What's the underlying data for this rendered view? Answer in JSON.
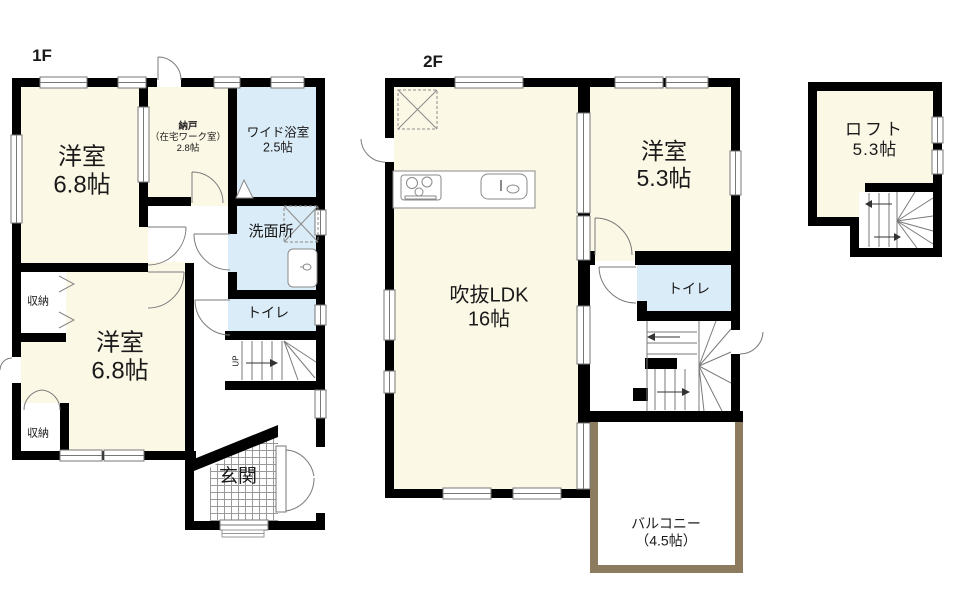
{
  "floors": {
    "f1": "1F",
    "f2": "2F"
  },
  "rooms": {
    "f1_yoshitsu1": {
      "name": "洋室",
      "size": "6.8帖"
    },
    "f1_nando": {
      "name": "納戸",
      "sub": "（在宅ワーク室）",
      "size": "2.8帖"
    },
    "f1_bath": {
      "name": "ワイド浴室",
      "size": "2.5帖"
    },
    "f1_senmenjo": {
      "name": "洗面所"
    },
    "f1_toilet": {
      "name": "トイレ"
    },
    "f1_shuno_upper": {
      "name": "収納"
    },
    "f1_yoshitsu2": {
      "name": "洋室",
      "size": "6.8帖"
    },
    "f1_shuno_lower": {
      "name": "収納"
    },
    "f1_genkan": {
      "name": "玄関"
    },
    "f1_stairs": {
      "label": "UP"
    },
    "f2_ldk": {
      "name": "吹抜LDK",
      "size": "16帖"
    },
    "f2_yoshitsu": {
      "name": "洋室",
      "size": "5.3帖"
    },
    "f2_toilet": {
      "name": "トイレ"
    },
    "f2_balcony": {
      "name": "バルコニー",
      "size": "（4.5帖）"
    },
    "loft_room": {
      "name": "ロフト",
      "size": "5.3帖"
    }
  },
  "icons": {
    "stove": "stove-icon",
    "kitchen_sink": "sink-icon",
    "vanity": "vanity-sink-icon",
    "washer_space": "washer-space-icon",
    "hatch": "inspection-hatch-icon",
    "bath_door": "folding-door-icon",
    "stairs": "staircase-icon",
    "window": "window-icon",
    "door": "door-swing-icon"
  },
  "colors": {
    "room_cream": "#FCF8E6",
    "wet_blue": "#DAECF7",
    "wall_black": "#000000",
    "balcony_tan": "#8C7B5F",
    "line_gray": "#7a7a7a"
  }
}
